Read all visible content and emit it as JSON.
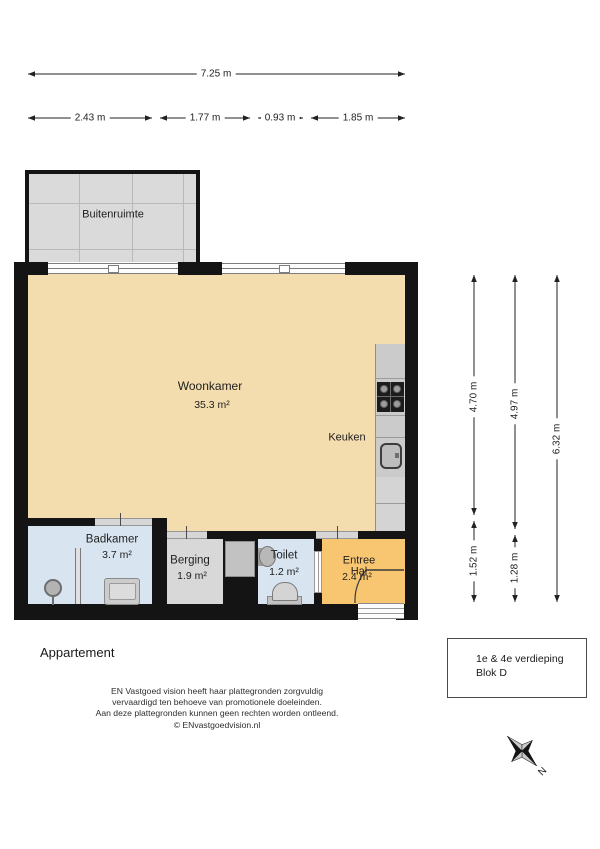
{
  "dimensions": {
    "width_total": "7.25 m",
    "width_segments": [
      "2.43 m",
      "1.77 m",
      "0.93 m",
      "1.85 m"
    ],
    "height_col1": [
      "4.70 m",
      "1.52 m"
    ],
    "height_col2": [
      "4.97 m",
      "1.28 m"
    ],
    "height_col3": [
      "6.32 m"
    ]
  },
  "rooms": {
    "buitenruimte": {
      "name": "Buitenruimte"
    },
    "woonkamer": {
      "name": "Woonkamer",
      "area": "35.3 m²"
    },
    "keuken": {
      "name": "Keuken"
    },
    "badkamer": {
      "name": "Badkamer",
      "area": "3.7 m²"
    },
    "berging": {
      "name": "Berging",
      "area": "1.9 m²"
    },
    "toilet": {
      "name": "Toilet",
      "area": "1.2 m²"
    },
    "entree": {
      "name_line1": "Entree",
      "name_line2": "Hal",
      "area": "2.4 m²"
    }
  },
  "footer": {
    "plan_title": "Appartement",
    "disclaimer": [
      "EN Vastgoed vision heeft haar plattegronden zorgvuldig",
      "vervaardigd ten behoeve van promotionele doeleinden.",
      "Aan deze plattegronden kunnen geen rechten worden ontleend.",
      "© ENvastgoedvision.nl"
    ],
    "info_box": {
      "line1": "1e & 4e verdieping",
      "line2": "Blok D"
    },
    "compass_label": "N"
  },
  "colors": {
    "floor_tan": "#f3dcad",
    "wet_room_blue": "#d8e4f0",
    "hall_orange": "#f8c671",
    "storage_gray": "#d8d8d8",
    "balcony_gray": "#dadada",
    "counter_gray": "#cbcbcb",
    "wall_black": "#141414"
  }
}
